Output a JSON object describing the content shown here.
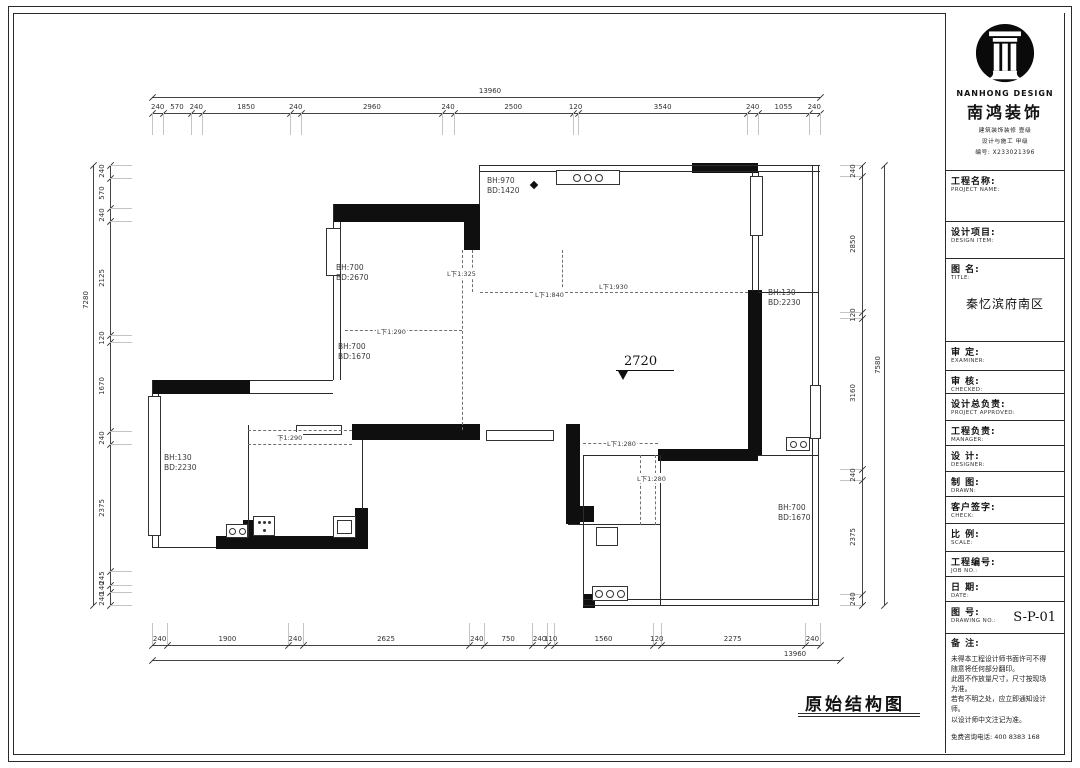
{
  "sheet": {
    "caption": "原始结构图"
  },
  "plan": {
    "level_mark": "2720",
    "beam_labels": [
      {
        "line1": "BH:970",
        "line2": "BD:1420"
      },
      {
        "line1": "BH:700",
        "line2": "BD:2670"
      },
      {
        "line1": "BH:700",
        "line2": "BD:1670"
      },
      {
        "line1": "BH:130",
        "line2": "BD:2230"
      },
      {
        "line1": "BH:130",
        "line2": "BD:2230"
      },
      {
        "line1": "BH:700",
        "line2": "BD:1670"
      }
    ],
    "beam_tags": [
      "L下1:325",
      "L下1:840",
      "L下1:930",
      "L下1:290",
      "下1:290",
      "L下1:280",
      "L下1:280"
    ],
    "dims": {
      "top_total": "13960",
      "top": [
        "240",
        "570",
        "240",
        "1850",
        "240",
        "2960",
        "240",
        "2500",
        "120",
        "3540",
        "240",
        "1055",
        "240"
      ],
      "bottom": [
        "240",
        "1900",
        "240",
        "2625",
        "240",
        "750",
        "240",
        "110",
        "1560",
        "120",
        "2275",
        "240"
      ],
      "bottom_total": "13960",
      "left": [
        "240",
        "570",
        "240",
        "2125",
        "120",
        "1670",
        "240",
        "2375",
        "245",
        "140",
        "240"
      ],
      "left_total": "7280",
      "right": [
        "240",
        "2850",
        "120",
        "3160",
        "240",
        "2375",
        "240"
      ],
      "right_total": "7580"
    }
  },
  "titleblock": {
    "logo_en": "NANHONG DESIGN",
    "logo_cn": "南鸿装饰",
    "cert_line1": "建筑装饰装修 壹级",
    "cert_line2": "设计与施工 甲级",
    "cert_line3": "编号: X233021396",
    "fields": [
      {
        "cn": "工程名称:",
        "en": "PROJECT NAME:",
        "value": ""
      },
      {
        "cn": "设计项目:",
        "en": "DESIGN ITEM:",
        "value": ""
      },
      {
        "cn": "图  名:",
        "en": "TITLE:",
        "value": "秦忆滨府南区"
      },
      {
        "cn": "审  定:",
        "en": "EXAMINER:",
        "value": ""
      },
      {
        "cn": "审  核:",
        "en": "CHECKED:",
        "value": ""
      },
      {
        "cn": "设计总负责:",
        "en": "PROJECT APPROVED:",
        "value": ""
      },
      {
        "cn": "工程负责:",
        "en": "MANAGER:",
        "value": ""
      },
      {
        "cn": "设  计:",
        "en": "DESIGNER:",
        "value": ""
      },
      {
        "cn": "制  图:",
        "en": "DRAWN:",
        "value": ""
      },
      {
        "cn": "客户签字:",
        "en": "CHECK:",
        "value": ""
      },
      {
        "cn": "比  例:",
        "en": "SCALE:",
        "value": ""
      },
      {
        "cn": "工程编号:",
        "en": "JOB NO.:",
        "value": ""
      },
      {
        "cn": "日  期:",
        "en": "DATE:",
        "value": ""
      },
      {
        "cn": "图  号:",
        "en": "DRAWING NO.:",
        "value": "S-P-01"
      }
    ],
    "notes_title": "备  注:",
    "notes": [
      "未得本工程设计师书面许可不得",
      "随意将任何部分翻印。",
      "此图不作放量尺寸，尺寸按现场",
      "为准。",
      "若有不明之处，应立即通知设计",
      "师。",
      "以设计师中文注记为准。"
    ],
    "hotline": "免费咨询电话: 400 8383 168"
  }
}
